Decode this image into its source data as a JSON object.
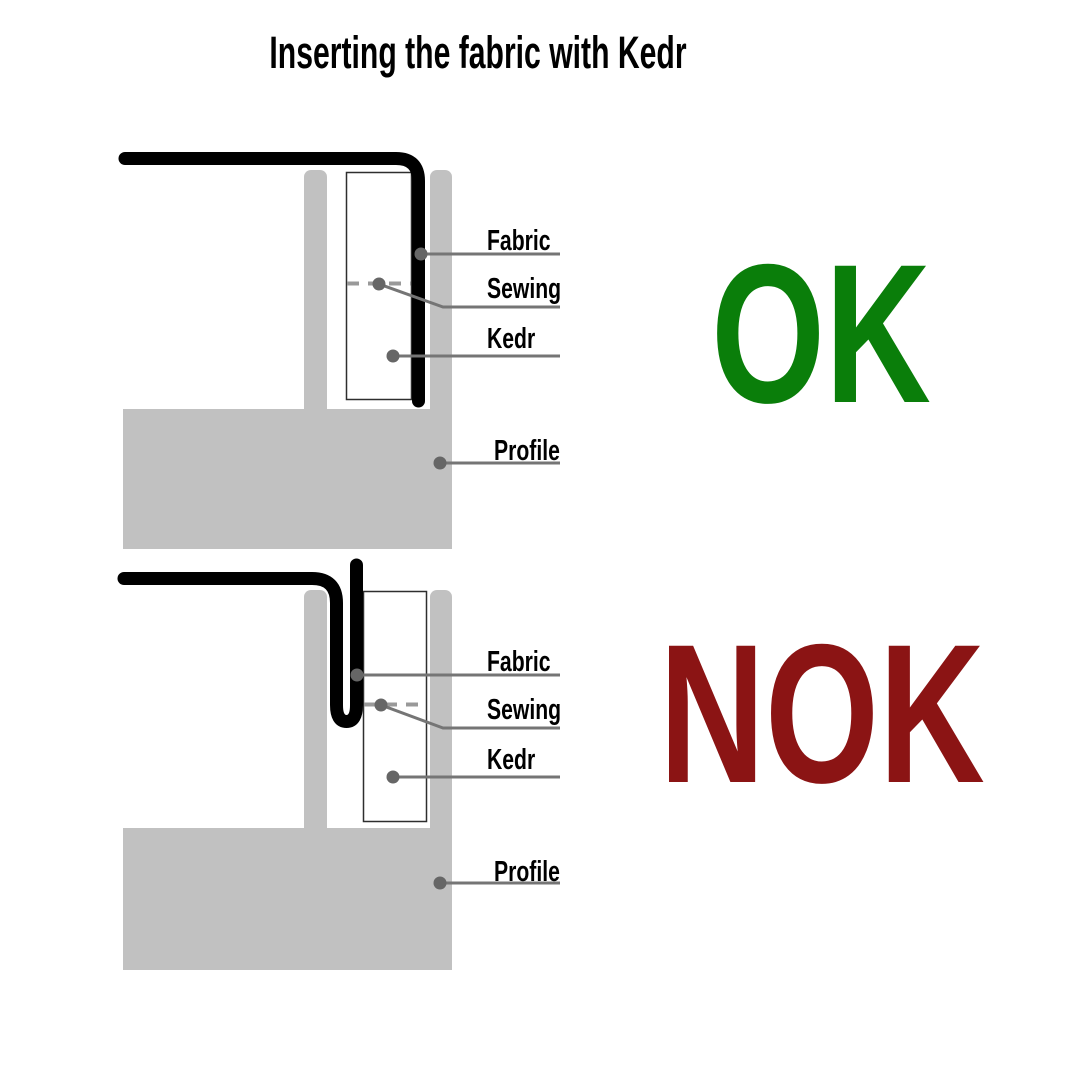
{
  "title": "Inserting the fabric with Kedr",
  "colors": {
    "ok_green": "#0a7e0a",
    "nok_red": "#8b1414",
    "profile_gray": "#c1c1c1",
    "kedr_white": "#ffffff",
    "fabric_black": "#000000",
    "leader_gray": "#757575",
    "dot_gray": "#666666",
    "sewing_dash_gray": "#999999"
  },
  "diagrams": [
    {
      "id": "ok",
      "verdict": "OK",
      "verdict_color": "#0a7e0a",
      "labels": {
        "fabric": "Fabric",
        "sewing": "Sewing",
        "kedr": "Kedr",
        "profile": "Profile"
      }
    },
    {
      "id": "nok",
      "verdict": "NOK",
      "verdict_color": "#8b1414",
      "labels": {
        "fabric": "Fabric",
        "sewing": "Sewing",
        "kedr": "Kedr",
        "profile": "Profile"
      }
    }
  ]
}
